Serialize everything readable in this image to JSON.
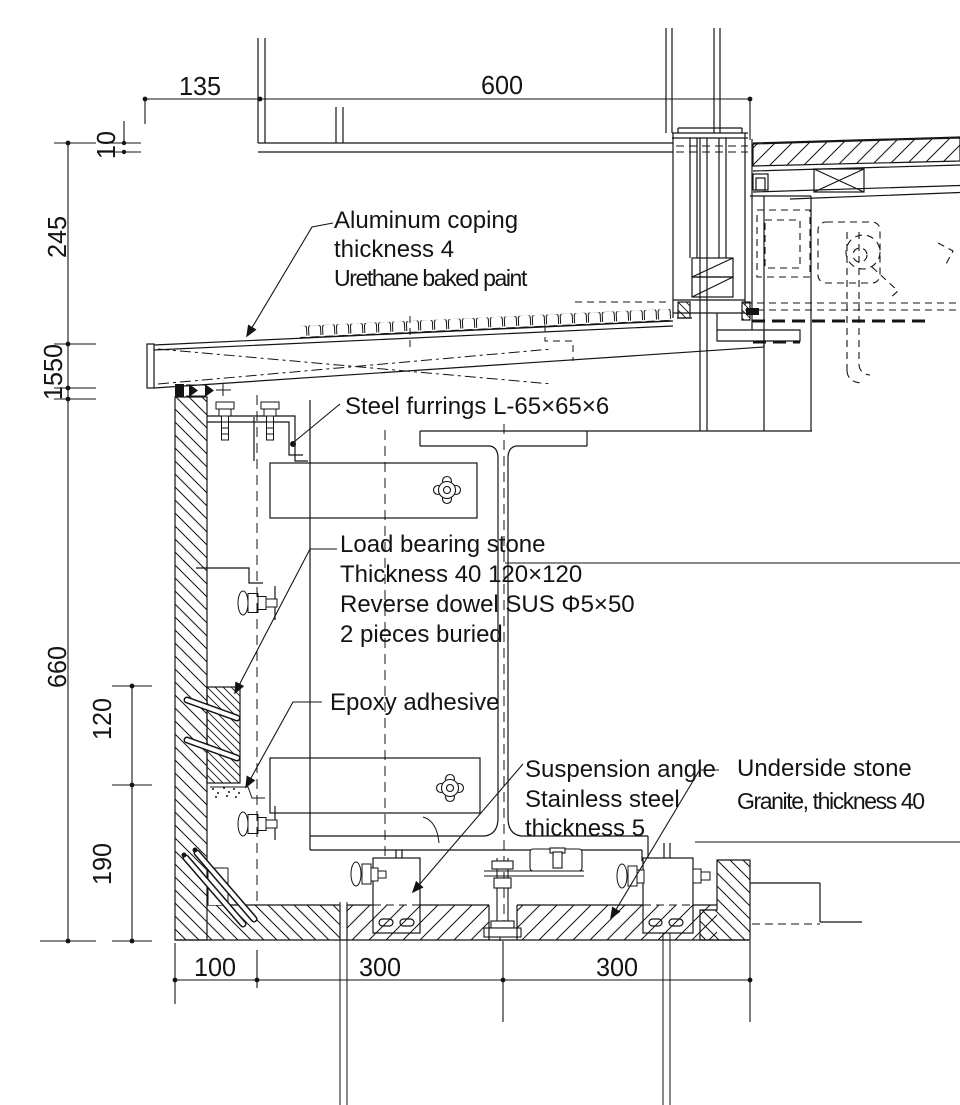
{
  "meta": {
    "drawing_type": "architectural parapet / coping section detail",
    "background_color": "#ffffff",
    "line_color": "#141414"
  },
  "callouts": {
    "aluminum_coping": {
      "l1": "Aluminum coping",
      "l2": "thickness 4",
      "l3": "Urethane baked paint"
    },
    "steel_furrings": {
      "l1": "Steel furrings L-65×65×6"
    },
    "load_bearing_stone": {
      "l1": "Load bearing stone",
      "l2": "Thickness 40 120×120",
      "l3": "Reverse dowel SUS Φ5×50",
      "l4": "2 pieces buried"
    },
    "epoxy_adhesive": {
      "l1": "Epoxy adhesive"
    },
    "suspension_angle": {
      "l1": "Suspension angle",
      "l2": "Stainless steel",
      "l3": "thickness 5"
    },
    "underside_stone": {
      "l1": "Underside stone",
      "l2": "Granite, thickness 40"
    }
  },
  "dims": {
    "top": [
      "135",
      "600"
    ],
    "left": [
      "10",
      "245",
      "1550",
      "660",
      "120",
      "190"
    ],
    "bottom": [
      "100",
      "300",
      "300"
    ]
  }
}
